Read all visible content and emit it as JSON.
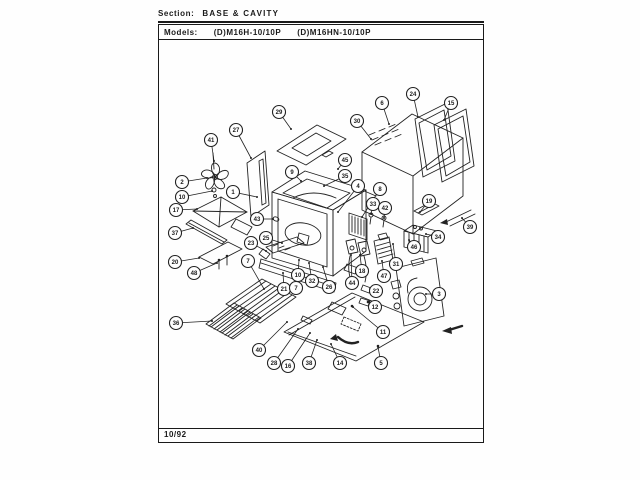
{
  "header": {
    "section_label": "Section:",
    "section_value": "BASE & CAVITY",
    "models_label": "Models:",
    "models": [
      "(D)M16H-10/10P",
      "(D)M16HN-10/10P"
    ]
  },
  "footer": {
    "date_code": "10/92"
  },
  "diagram": {
    "description": "Exploded parts view - microwave oven base and cavity",
    "ink_color": "#1a1a1a",
    "callouts": [
      {
        "n": "41",
        "cx": 211,
        "cy": 140,
        "tx": 214,
        "ty": 161
      },
      {
        "n": "2",
        "cx": 182,
        "cy": 182,
        "tx": 207,
        "ty": 178
      },
      {
        "n": "10",
        "cx": 182,
        "cy": 197,
        "tx": 212,
        "ty": 191
      },
      {
        "n": "17",
        "cx": 176,
        "cy": 210,
        "tx": 197,
        "ty": 209
      },
      {
        "n": "37",
        "cx": 175,
        "cy": 233,
        "tx": 193,
        "ty": 228
      },
      {
        "n": "20",
        "cx": 175,
        "cy": 262,
        "tx": 199,
        "ty": 258
      },
      {
        "n": "48",
        "cx": 194,
        "cy": 273,
        "tx": 217,
        "ty": 263
      },
      {
        "n": "36",
        "cx": 176,
        "cy": 323,
        "tx": 212,
        "ty": 321
      },
      {
        "n": "27",
        "cx": 236,
        "cy": 130,
        "tx": 251,
        "ty": 158
      },
      {
        "n": "1",
        "cx": 233,
        "cy": 192,
        "tx": 257,
        "ty": 197
      },
      {
        "n": "29",
        "cx": 279,
        "cy": 112,
        "tx": 291,
        "ty": 129
      },
      {
        "n": "9",
        "cx": 292,
        "cy": 172,
        "tx": 301,
        "ty": 181
      },
      {
        "n": "43",
        "cx": 257,
        "cy": 219,
        "tx": 273,
        "ty": 219
      },
      {
        "n": "25",
        "cx": 266,
        "cy": 238,
        "tx": 282,
        "ty": 243
      },
      {
        "n": "23",
        "cx": 251,
        "cy": 243,
        "tx": 266,
        "ty": 251
      },
      {
        "n": "7",
        "cx": 248,
        "cy": 261,
        "tx": 264,
        "ty": 289
      },
      {
        "n": "21",
        "cx": 284,
        "cy": 289,
        "tx": 283,
        "ty": 273
      },
      {
        "n": "7",
        "cx": 296,
        "cy": 288,
        "tx": 295,
        "ty": 270
      },
      {
        "n": "10",
        "cx": 298,
        "cy": 275,
        "tx": 299,
        "ty": 260
      },
      {
        "n": "32",
        "cx": 312,
        "cy": 281,
        "tx": 309,
        "ty": 263
      },
      {
        "n": "26",
        "cx": 329,
        "cy": 287,
        "tx": 323,
        "ty": 267
      },
      {
        "n": "45",
        "cx": 345,
        "cy": 160,
        "tx": 338,
        "ty": 169
      },
      {
        "n": "35",
        "cx": 345,
        "cy": 176,
        "tx": 324,
        "ty": 186
      },
      {
        "n": "4",
        "cx": 358,
        "cy": 186,
        "tx": 338,
        "ty": 212
      },
      {
        "n": "8",
        "cx": 380,
        "cy": 189,
        "tx": 362,
        "ty": 217
      },
      {
        "n": "30",
        "cx": 357,
        "cy": 121,
        "tx": 371,
        "ty": 139
      },
      {
        "n": "6",
        "cx": 382,
        "cy": 103,
        "tx": 389,
        "ty": 124
      },
      {
        "n": "24",
        "cx": 413,
        "cy": 94,
        "tx": 418,
        "ty": 117
      },
      {
        "n": "15",
        "cx": 451,
        "cy": 103,
        "tx": 444,
        "ty": 120
      },
      {
        "n": "33",
        "cx": 373,
        "cy": 204,
        "tx": 371,
        "ty": 214
      },
      {
        "n": "42",
        "cx": 385,
        "cy": 208,
        "tx": 384,
        "ty": 218
      },
      {
        "n": "19",
        "cx": 429,
        "cy": 201,
        "tx": 420,
        "ty": 212
      },
      {
        "n": "34",
        "cx": 438,
        "cy": 237,
        "tx": 426,
        "ty": 234
      },
      {
        "n": "46",
        "cx": 414,
        "cy": 247,
        "tx": 409,
        "ty": 240
      },
      {
        "n": "39",
        "cx": 470,
        "cy": 227,
        "tx": 462,
        "ty": 218
      },
      {
        "n": "31",
        "cx": 396,
        "cy": 264,
        "tx": 393,
        "ty": 244
      },
      {
        "n": "47",
        "cx": 384,
        "cy": 276,
        "tx": 382,
        "ty": 261
      },
      {
        "n": "18",
        "cx": 362,
        "cy": 271,
        "tx": 360,
        "ty": 255
      },
      {
        "n": "44",
        "cx": 352,
        "cy": 283,
        "tx": 351,
        "ty": 255
      },
      {
        "n": "22",
        "cx": 376,
        "cy": 291,
        "tx": 370,
        "ty": 289
      },
      {
        "n": "12",
        "cx": 375,
        "cy": 307,
        "tx": 369,
        "ty": 302
      },
      {
        "n": "3",
        "cx": 439,
        "cy": 294,
        "tx": 426,
        "ty": 294
      },
      {
        "n": "11",
        "cx": 383,
        "cy": 332,
        "tx": 353,
        "ty": 307
      },
      {
        "n": "5",
        "cx": 381,
        "cy": 363,
        "tx": 378,
        "ty": 347
      },
      {
        "n": "14",
        "cx": 340,
        "cy": 363,
        "tx": 331,
        "ty": 344
      },
      {
        "n": "38",
        "cx": 309,
        "cy": 363,
        "tx": 317,
        "ty": 340
      },
      {
        "n": "16",
        "cx": 288,
        "cy": 366,
        "tx": 310,
        "ty": 333
      },
      {
        "n": "28",
        "cx": 274,
        "cy": 363,
        "tx": 298,
        "ty": 329
      },
      {
        "n": "40",
        "cx": 259,
        "cy": 350,
        "tx": 287,
        "ty": 322
      }
    ]
  }
}
